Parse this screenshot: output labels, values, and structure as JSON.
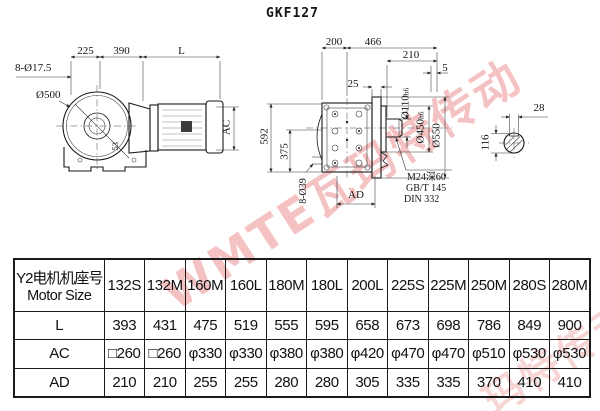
{
  "title": "GKF127",
  "watermark": {
    "text_main": "WMTE瓦玛特传动",
    "text_secondary": "玛特传动",
    "color": "#e78080"
  },
  "side_view": {
    "dim_top_1": "225",
    "dim_top_2": "390",
    "dim_top_3": "L",
    "bolt_holes": "8-Ø17.5",
    "flange_diameter": "Ø500",
    "hub_label": "53",
    "motor_diameter": "AC"
  },
  "front_view": {
    "dim_top_1": "200",
    "dim_top_2": "466",
    "dim_top_3": "210",
    "dim_top_4": "5",
    "dim_top_5": "25",
    "overall_height": "592",
    "dim_375": "375",
    "bolt_holes": "8-Ø39",
    "dim_ad": "AD",
    "shaft_diameter": "Ø110",
    "shaft_fit": "h6",
    "spigot_diameter": "Ø450",
    "spigot_fit": "h6",
    "flange_diameter": "Ø550",
    "tapped_hole": "M24深60",
    "standard_1": "GB/T 145",
    "standard_2": "DIN 332"
  },
  "key_detail": {
    "key_width": "28",
    "shaft_height": "116"
  },
  "table": {
    "header_line1": "Y2电机机座号",
    "header_line2": "Motor Size",
    "columns": [
      "132S",
      "132M",
      "160M",
      "160L",
      "180M",
      "180L",
      "200L",
      "225S",
      "225M",
      "250M",
      "280S",
      "280M"
    ],
    "rows": [
      {
        "label": "L",
        "values": [
          "393",
          "431",
          "475",
          "519",
          "555",
          "595",
          "658",
          "673",
          "698",
          "786",
          "849",
          "900"
        ]
      },
      {
        "label": "AC",
        "values": [
          "□260",
          "□260",
          "φ330",
          "φ330",
          "φ380",
          "φ380",
          "φ420",
          "φ470",
          "φ470",
          "φ510",
          "φ530",
          "φ530"
        ]
      },
      {
        "label": "AD",
        "values": [
          "210",
          "210",
          "255",
          "255",
          "280",
          "280",
          "305",
          "335",
          "335",
          "370",
          "410",
          "410"
        ]
      }
    ]
  }
}
